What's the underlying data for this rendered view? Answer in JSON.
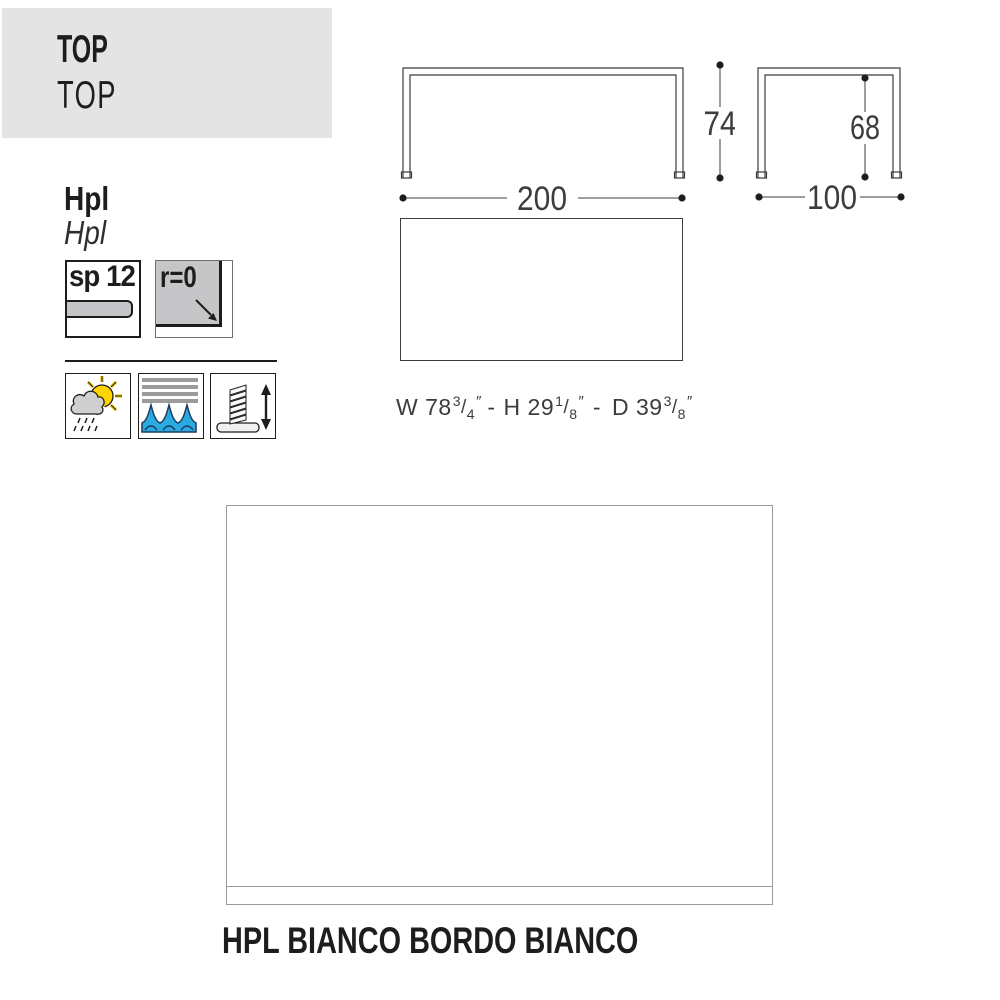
{
  "header": {
    "title_bold": "TOP",
    "title_regular": "TOP"
  },
  "material": {
    "label_bold": "Hpl",
    "label_italic": "Hpl"
  },
  "specs": {
    "thickness": "sp 12",
    "edge_radius": "r=0",
    "thickness_icon": "panel-thickness-bar-icon",
    "radius_icon": "corner-radius-arrow-icon"
  },
  "feature_icons": [
    "weather-resistant-icon",
    "water-resistant-icon",
    "adjustable-feet-icon"
  ],
  "drawings": {
    "front_width": "200",
    "front_height": "74",
    "side_width": "100",
    "side_height": "68"
  },
  "imperial": {
    "w_label": "W 78",
    "w_num": "3",
    "w_den": "4",
    "h_label": "H 29",
    "h_num": "1",
    "h_den": "8",
    "d_label": "D 39",
    "d_num": "3",
    "d_den": "8",
    "slash": "/",
    "unit": "″",
    "separator": "-"
  },
  "caption": "HPL BIANCO BORDO BIANCO",
  "colors": {
    "header_bg": "#e4e4e4",
    "swatch_gray": "#c6c6c8",
    "wave_blue": "#29abe2",
    "wave_outline": "#1f3a5f",
    "sun_yellow": "#ffd400",
    "stripe_gray": "#9b9b9b",
    "drawing_line": "#3c3c3b",
    "text": "#1d1d1b",
    "swatch_border": "#9a9a9a"
  }
}
